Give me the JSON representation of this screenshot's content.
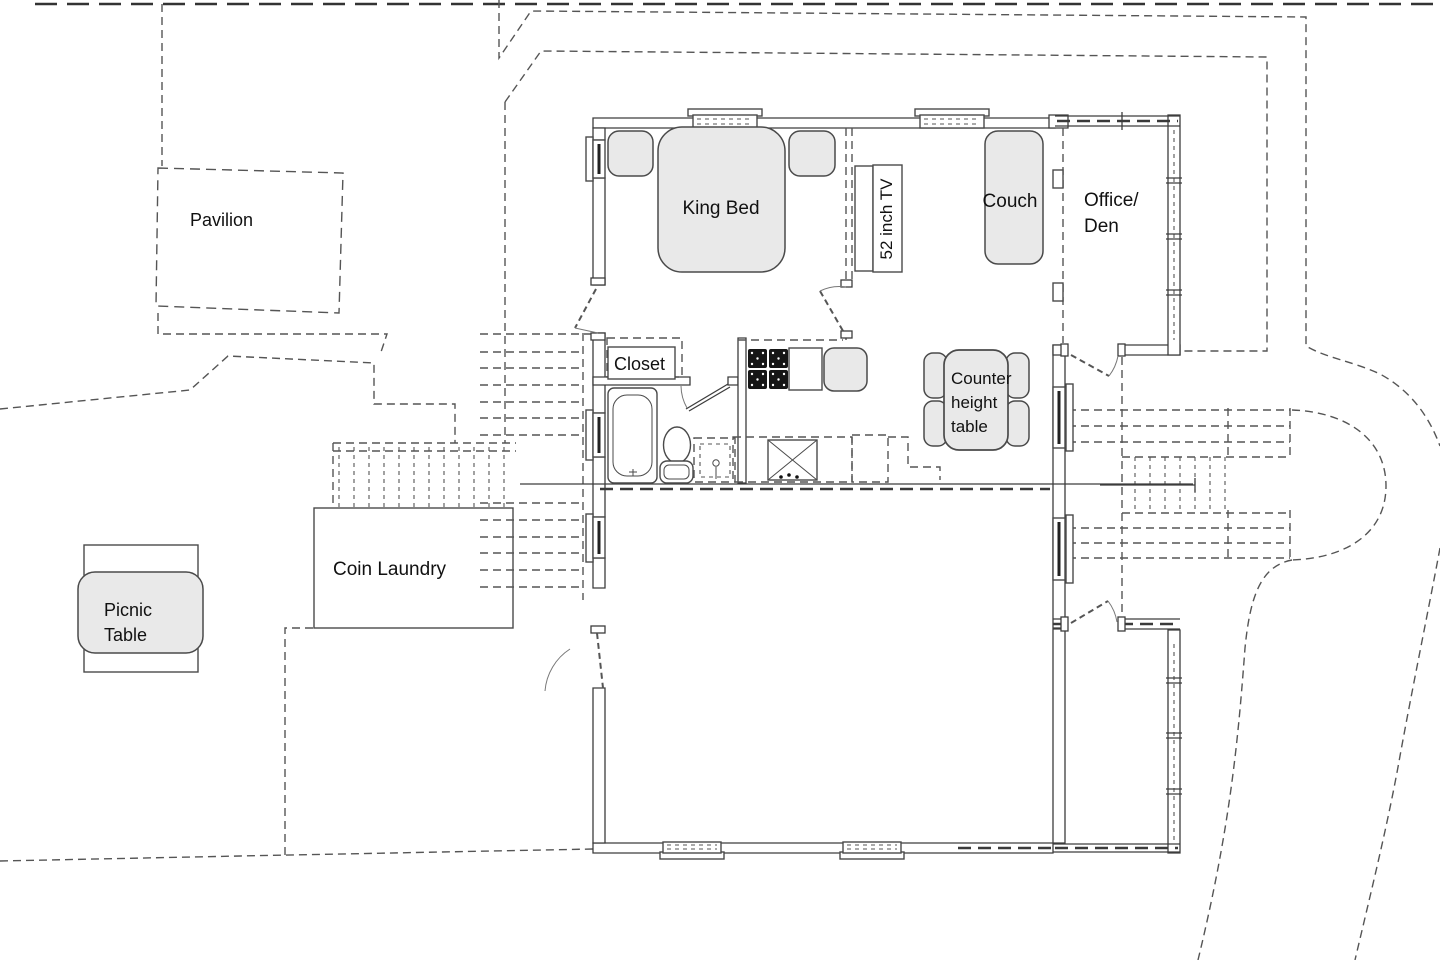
{
  "colors": {
    "wall_line": "#3d3d3d",
    "dashed_line": "#555555",
    "furniture_fill": "#e9e9e9",
    "burner_dark": "#161616",
    "background": "#ffffff",
    "text": "#111111"
  },
  "plan": {
    "outdoor": {
      "pavilion": "Pavilion",
      "coin_laundry": "Coin Laundry",
      "picnic_line1": "Picnic",
      "picnic_line2": "Table"
    },
    "rooms": {
      "office_line1": "Office/",
      "office_line2": "Den",
      "closet": "Closet"
    },
    "furniture": {
      "king_bed": "King Bed",
      "tv": "52 inch TV",
      "couch": "Couch",
      "counter_line1": "Counter",
      "counter_line2": "height",
      "counter_line3": "table"
    }
  }
}
